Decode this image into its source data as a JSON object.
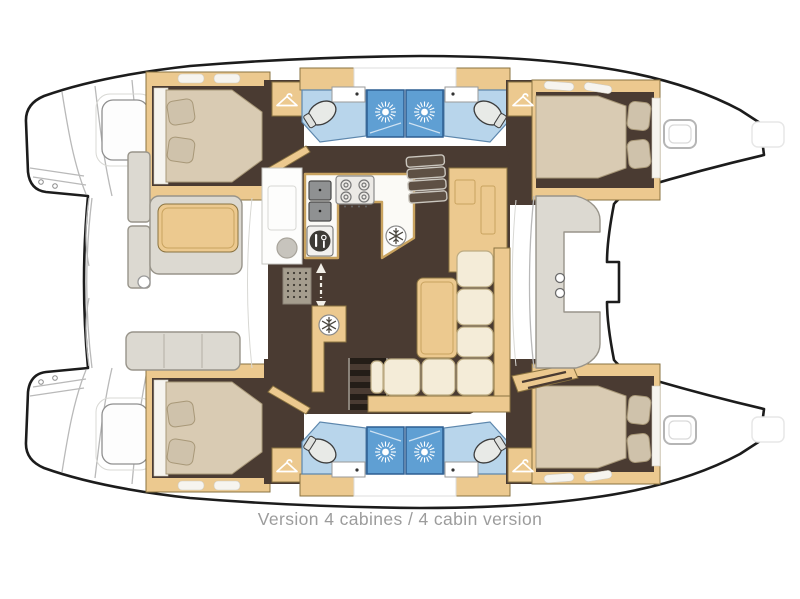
{
  "diagram": {
    "type": "boat-floorplan",
    "subject": "catamaran deck plan, 4 cabin version, bow to the right",
    "rooms": "2 hull cabins forward, 2 hull cabins aft, 4 bathrooms with central shower stalls, saloon with U-shaped galley, aft cockpit with table, forward cockpit bench"
  },
  "caption": {
    "text": "Version 4 cabines / 4 cabin version"
  },
  "colors": {
    "hull-line": "#1c1c1c",
    "wood": "#ecc98f",
    "wood-edge": "#8a7340",
    "wood-inner": "#c9a35f",
    "floor": "#4a3b32",
    "mattress": "#d9cbb3",
    "mattress-edge": "#a89878",
    "pillow": "#cfc2ab",
    "linen": "#f6f4ef",
    "bath-floor": "#b8d5eb",
    "bath-edge": "#5d87ad",
    "shower": "#5f9fd3",
    "shower-edge": "#2d5e92",
    "seat-gray": "#dcd9d1",
    "seat-edge": "#98948a",
    "sofa": "#f4ecd8",
    "sofa-edge": "#bcab82",
    "steel": "#8f9192",
    "caption-gray": "#9c9c9c",
    "line-gray": "#b9b9b9"
  },
  "icons": {
    "shower": "sunburst-showerhead",
    "fridge": "snowflake",
    "wardrobe": "clothes-hanger",
    "stove": "four-burner-hob",
    "oven": "cutlery-plate",
    "companionway": "double-headed-arrow"
  }
}
